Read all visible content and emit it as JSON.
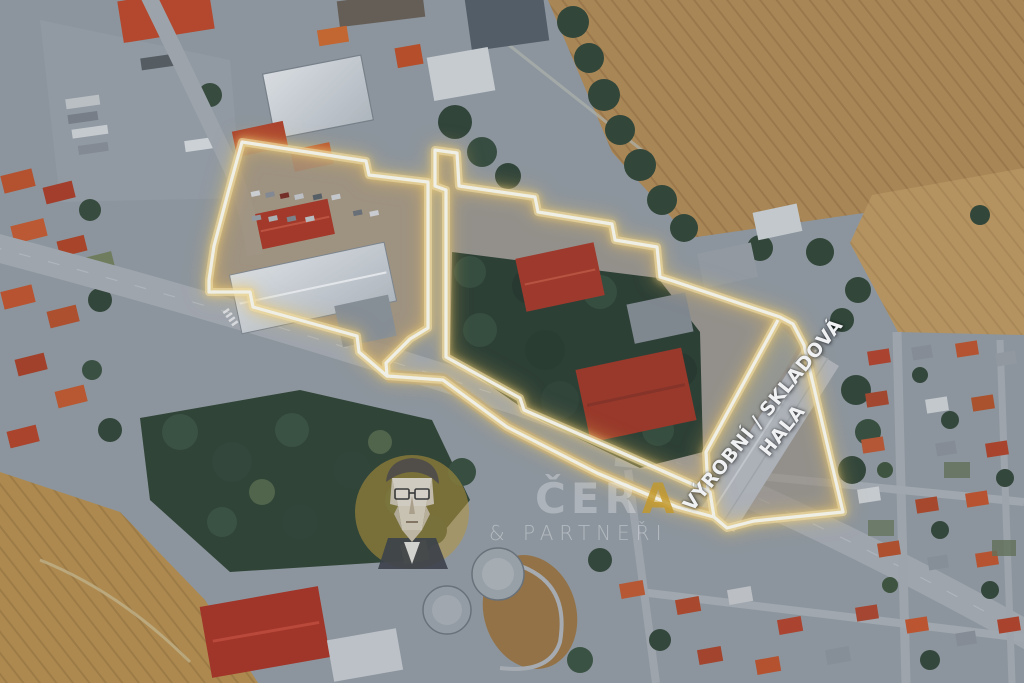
{
  "image": {
    "kind": "aerial-satellite-property-photo",
    "width_px": 1024,
    "height_px": 683
  },
  "annotation": {
    "label_line1": "VÝROBNÍ / SKLADOVÁ",
    "label_line2": "HALA",
    "label_rotation_deg": -51,
    "label_color": "#ffffff",
    "outline_color": "#fffdf2",
    "outline_glow_color": "#ffd878"
  },
  "watermark": {
    "brand_white": "ČER",
    "brand_gold": "A",
    "partners": "& PARTNEŘI",
    "gold_color": "#cfa028",
    "portrait_icon": "low-poly-man-with-glasses"
  },
  "scene": {
    "features": [
      "industrial-yard-outlined",
      "production-storage-hall",
      "central-forest",
      "farm-fields-top-right",
      "farm-field-bottom-left",
      "main-road-diagonal",
      "residential-grid-right",
      "water-tanks-bottom-center",
      "truck-parking-top-left"
    ]
  }
}
